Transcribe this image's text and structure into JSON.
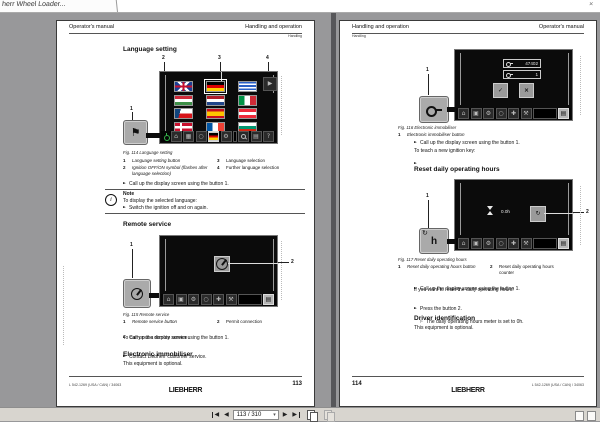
{
  "tab": {
    "title": "herr Wheel Loader...",
    "close": "×"
  },
  "statusbar": {
    "page_field": "113 / 310"
  },
  "logo": "LIEBHERR",
  "common": {
    "operators_manual": "Operator's manual",
    "handling_operation": "Handling and operation",
    "handling": "Handling",
    "call_up": "Call up the display screen using the button 1.",
    "optional": "This equipment is optional."
  },
  "left": {
    "page_number": "113",
    "doc_code": "L 542-1269 (USA / CAN) / 34063",
    "language": {
      "title": "Language setting",
      "caption": "Fig. 114 Language setting",
      "callout1": "1",
      "callout2": "2",
      "callout3": "3",
      "callout4": "4",
      "legend1_num": "1",
      "legend1": "Language setting button",
      "legend2_num": "2",
      "legend2": "Ignition OFF/ON symbol (flashes after language selection)",
      "legend3_num": "3",
      "legend3": "Language selection",
      "legend4_num": "4",
      "legend4": "Further language selection",
      "note_title": "Note",
      "note_line": "To display the selected language:",
      "note_bullet": "Switch the ignition off and on again.",
      "flags": [
        "uk",
        "de",
        "gr",
        "hu",
        "nl",
        "it",
        "cz",
        "es",
        "at",
        "dk",
        "fr",
        "bg"
      ],
      "selected_flag": "de"
    },
    "remote": {
      "title": "Remote service",
      "caption": "Fig. 115 Remote service",
      "callout1": "1",
      "callout2": "2",
      "legend1_num": "1",
      "legend1": "Remote service button",
      "legend2_num": "2",
      "legend2": "Permit connection",
      "line1": "To carry out a remote service:",
      "bullet2": "Contact Liebherr customer service."
    },
    "immobiliser": {
      "title": "Electronic immobiliser"
    }
  },
  "right": {
    "page_number": "114",
    "doc_code": "L 542-1269 (USA / CAN) / 34063",
    "immobiliser": {
      "caption": "Fig. 116 Electronic immobiliser",
      "callout1": "1",
      "legend1_num": "1",
      "legend1": "Electronic immobiliser button",
      "line1": "To teach a new ignition key:",
      "code_value": "47402",
      "key_row_value": "1"
    },
    "reset": {
      "title": "Reset daily operating hours",
      "caption": "Fig. 117 Reset daily operating hours",
      "callout1": "1",
      "callout2": "2",
      "legend1_num": "1",
      "legend1": "Reset daily operating hours button",
      "legend2_num": "2",
      "legend2": "Reset daily operating hours counter",
      "hours_value": "0.0h",
      "line1": "If you want to reset the daily operating hours:",
      "bullet2": "Press the button 2.",
      "result": "The daily operating hours meter is set to 0h."
    },
    "driver": {
      "title": "Driver identification"
    }
  }
}
